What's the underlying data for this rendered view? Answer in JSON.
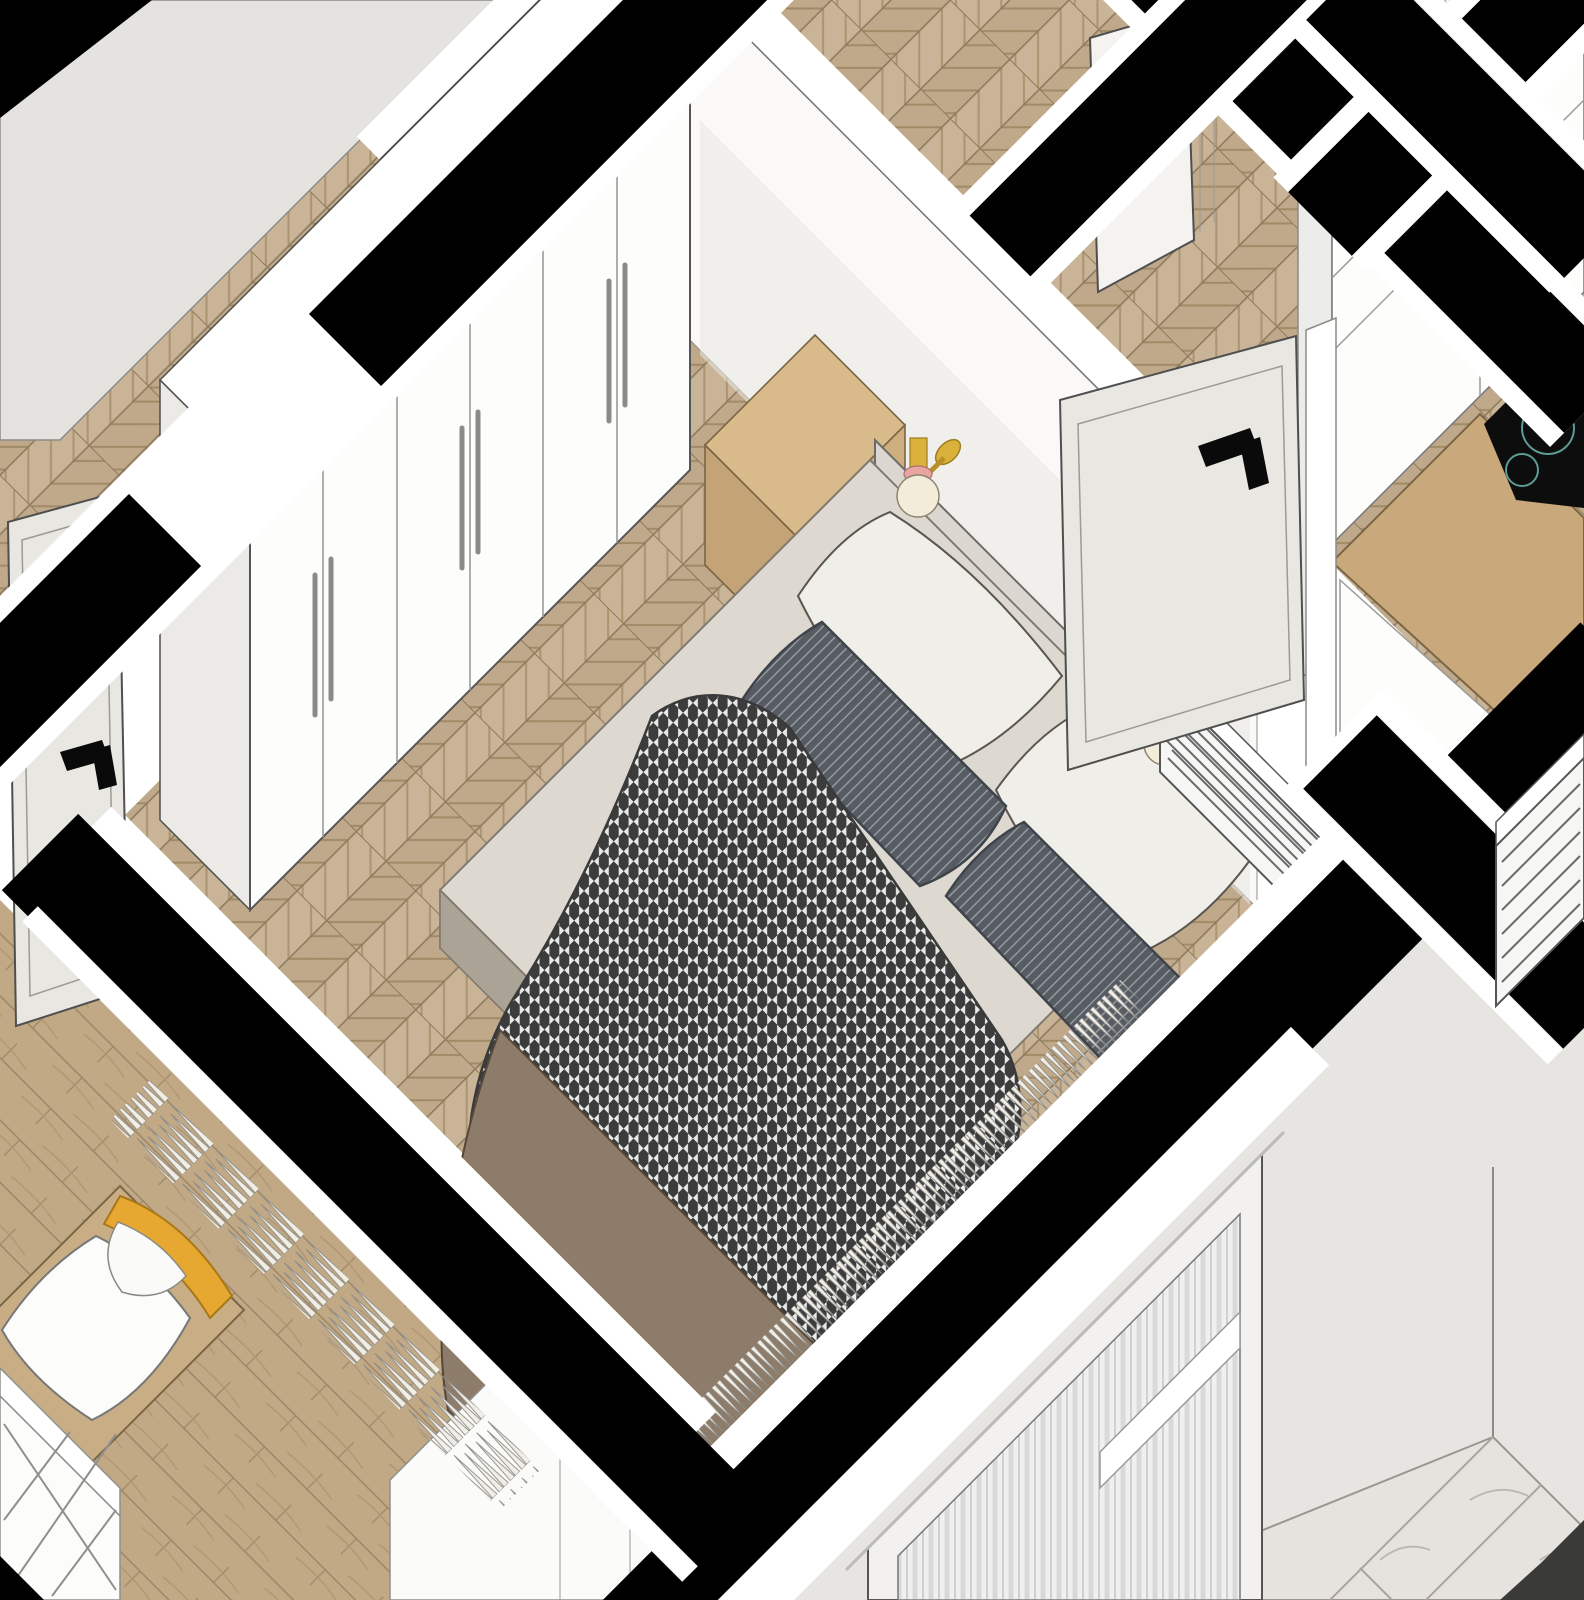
{
  "meta": {
    "title": "Isometric apartment cut-away rendering, master bedroom focus",
    "projection": "plan-oblique 45-degree axonometric, walls cut in black poche",
    "style": "SketchUp-like interior visualization, no visible text"
  },
  "rooms": [
    {
      "id": "bedroom",
      "label": "Master bedroom",
      "floor": "chevron oak parquet",
      "furniture": [
        "six-door white wardrobe with bar handles",
        "upholstered double bed",
        "houndstooth duvet",
        "brown throw blanket",
        "grey striped lumbar pillows",
        "white pillows",
        "oak nightstand with two drawers",
        "two brass-and-pink wall lamps",
        "white slatted radiator",
        "sheer curtain cross-section",
        "open white door"
      ]
    },
    {
      "id": "hallway",
      "label": "Hallway",
      "floor": "chevron oak parquet",
      "features": [
        "white door ajar with black lever handle",
        "grey door with black lever handle"
      ]
    },
    {
      "id": "kitchen",
      "label": "Kitchen corner",
      "features": [
        "white flat-front cabinets",
        "oak worktop with rounded corner",
        "black induction hob with teal burner rings"
      ]
    },
    {
      "id": "kids-room",
      "label": "Second bedroom",
      "floor": "wide oak planks",
      "furniture": [
        "bed with white duvet",
        "curved yellow headboard panel",
        "white lattice console",
        "curtain cross-section"
      ]
    },
    {
      "id": "bathroom",
      "label": "Bathroom",
      "floor": "grey marble tiles",
      "features": [
        "light grey walls",
        "dark floor drain strip"
      ]
    },
    {
      "id": "utility",
      "label": "Adjacent room",
      "features": [
        "second slatted radiator",
        "grey armchair partially visible",
        "striped drape panel"
      ]
    }
  ],
  "colors": {
    "page": "#ffffff",
    "cut": "#000000",
    "wallTop": "#ffffff",
    "wallFace": "#faf9f7",
    "wallShadow": "#e9e7e2",
    "grayWall": "#e7e5e1",
    "grayWallTL": "#e5e3df",
    "chevA": "#c9b497",
    "chevB": "#bfa98a",
    "chevSeam": "#8d7a5e",
    "chevGrain": "#ab946f",
    "plank": "#c2a986",
    "plankSeam": "#9c8666",
    "marble": "#e6e3de",
    "marbleLine": "#a9a59e",
    "wardrobeFront": "#fdfdfc",
    "wardrobeSide": "#eceae6",
    "wardrobeTop": "#ffffff",
    "handleBar": "#8a8a8a",
    "nightTop": "#d9ba8b",
    "nightFront": "#c4a476",
    "nightSide": "#cfae7f",
    "nightEdge": "#7a6644",
    "headboard": "#dbd7d0",
    "sheet": "#ddd8d0",
    "bedBaseFoot": "#aba396",
    "bedBaseSide": "#b8b1a5",
    "pillowWhite": "#f0eee8",
    "pillowDark": "#575c63",
    "pillowStripe": "#9da3ab",
    "pillowBeige": "#cfc7ba",
    "strap": "#8a7358",
    "houndDark": "#3c3c3c",
    "houndLight": "#e9e9e9",
    "blanket": "#8e7c6a",
    "lampGold": "#d9b13b",
    "lampPink": "#e9a3a0",
    "lampGlobe": "#f3ecd8",
    "radiator": "#f6f6f4",
    "radiatorSlat": "#6a6a6a",
    "radiatorCap": "#e8e8e6",
    "doorLeaf": "#e9e7e2",
    "doorWhite": "#f4f3f0",
    "leverBlack": "#0a0a0a",
    "kidsFrame": "#c9ae85",
    "kidsYellow": "#e7a832",
    "kidsDuvet": "#fcfcfb",
    "lattice": "#fcfcfb",
    "fringe": "#f1eee6",
    "armchair": "#b7b2aa",
    "counterWood": "#c9a87b",
    "cooktop": "#0d0d0d",
    "hobRing": "#5d9b95",
    "cabinet": "#fdfdfc",
    "cabinetSide": "#ececea",
    "glass": "#eff0ef",
    "transom": "#ffffff",
    "drain": "#3a3a38",
    "whiteFurniture": "#fbfbfa"
  }
}
